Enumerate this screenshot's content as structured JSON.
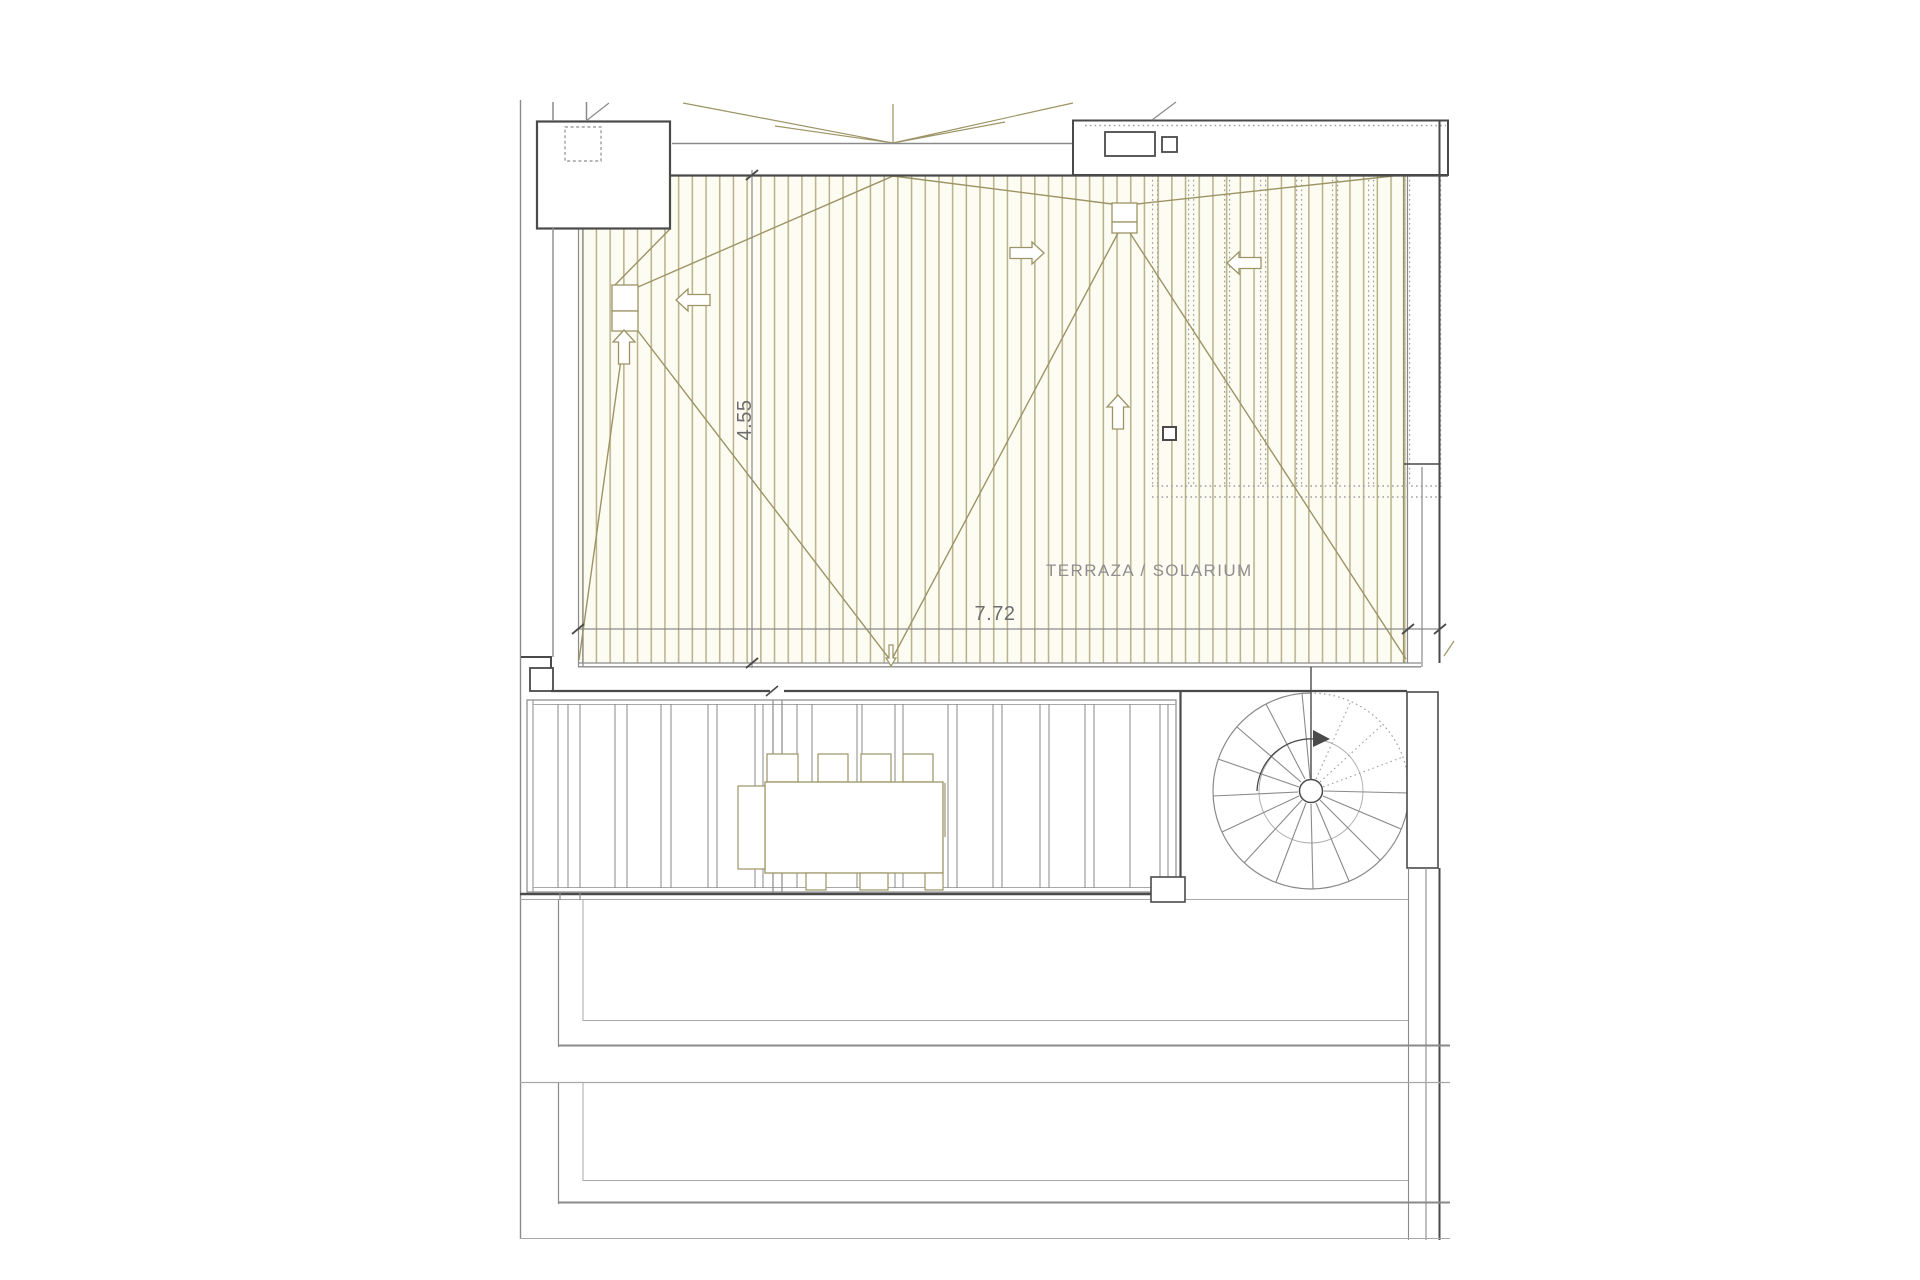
{
  "page": {
    "title": "Roof terrace / solarium floor plan"
  },
  "labels": {
    "room": "TERRAZA / SOLARIUM"
  },
  "dimensions": {
    "terrace_depth": "4.55",
    "terrace_width": "7.72"
  },
  "icons": {
    "slope_arrows": "roof-slope-direction-arrows",
    "drain": "roof-drain-boxes",
    "stair_rotation": "spiral-stair-direction-arrow"
  },
  "colors": {
    "paper": "#ffffff",
    "wall_dark": "#4a4a4a",
    "wall_gray": "#8a8a8a",
    "line_light": "#a8a8a8",
    "roof_line": "#9c9465",
    "roof_hatch": "#b8b18a",
    "hatch_bg": "#fdfcf3",
    "dotted": "#9f9f9f",
    "dim_line": "#8a8a8a",
    "dim_text": "#6d6d6d",
    "text_gray": "#8f8f8f"
  }
}
